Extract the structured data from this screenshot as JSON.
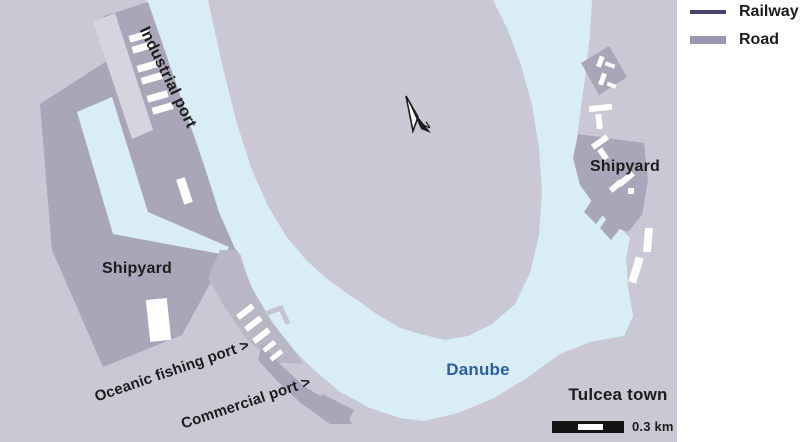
{
  "legend": {
    "items": [
      {
        "label": "Railway",
        "swatch": "line",
        "color": "#45446b"
      },
      {
        "label": "Road",
        "swatch": "band",
        "color": "#9a97b4"
      }
    ]
  },
  "map": {
    "labels": {
      "industrial_port": "Industrial port",
      "shipyard_left": "Shipyard",
      "shipyard_right": "Shipyard",
      "oceanic_fishing_port": "Oceanic fishing port >",
      "commercial_port": "Commercial port >",
      "river": "Danube",
      "town": "Tulcea town"
    },
    "north_arrow": {
      "label": "N"
    },
    "scale_bar": {
      "label": "0.3 km"
    },
    "colors": {
      "land": "#cac8d4",
      "water": "#d8edf6",
      "port_area": "#a9a6ba",
      "quay_band": "#b9b6c6",
      "road_strip": "#d6d4de",
      "building": "#ffffff",
      "railway": "#45446b",
      "road": "#9a97b4",
      "river_label_text": "#2a5fa8",
      "label_text": "#1c1c1c"
    }
  }
}
